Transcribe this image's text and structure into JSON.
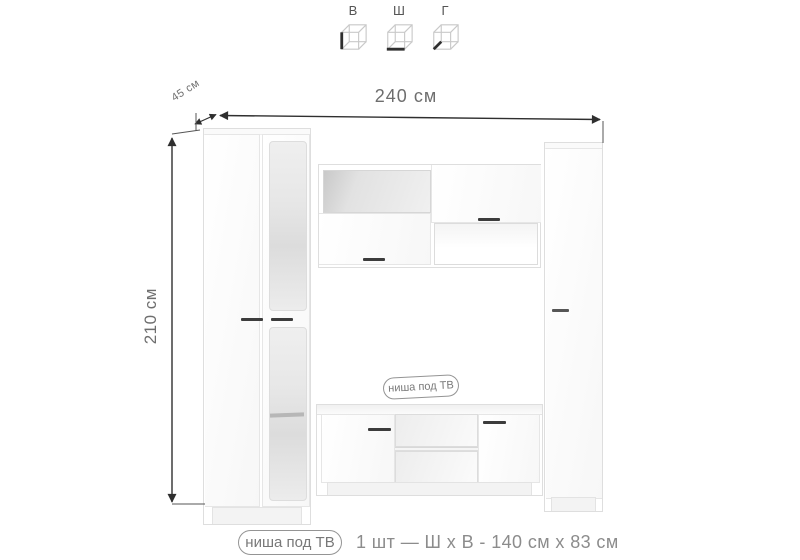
{
  "colors": {
    "background": "#ffffff",
    "dimension_line": "#2f2f2f",
    "dimension_text": "#6e6e6e",
    "caption_text": "#8c8c8c",
    "furniture_edge": "#e2e2e2",
    "handle": "#3c3c3c"
  },
  "legend": {
    "items": [
      {
        "label": "В",
        "icon": "cube-height-edge-icon"
      },
      {
        "label": "Ш",
        "icon": "cube-width-edge-icon"
      },
      {
        "label": "Г",
        "icon": "cube-depth-edge-icon"
      }
    ]
  },
  "dimensions": {
    "width_label": "240 см",
    "height_label": "210 см",
    "depth_label": "45 см"
  },
  "tv_niche_badge": "ниша под ТВ",
  "footer": {
    "badge": "ниша под ТВ",
    "spec": "1 шт — Ш х В - 140 см х 83 см"
  }
}
